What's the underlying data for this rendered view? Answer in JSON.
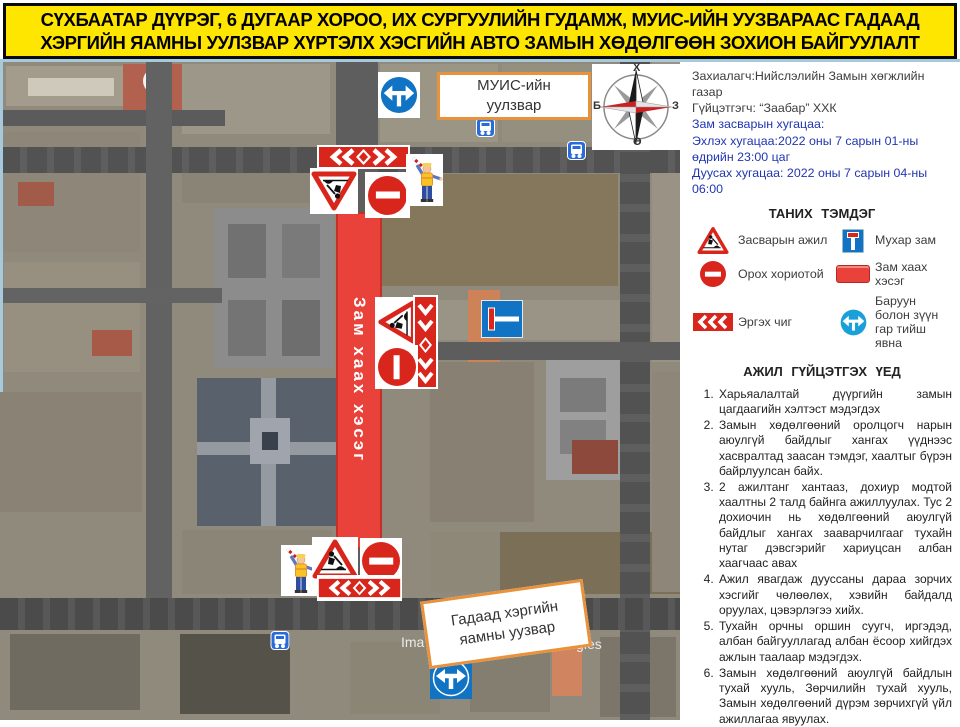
{
  "title": {
    "line1": "СҮХБААТАР ДҮҮРЭГ, 6 ДУГААР ХОРОО, ИХ СУРГУУЛИЙН ГУДАМЖ, МУИС-ИЙН УУЗВАРААС ГАДААД",
    "line2": "ХЭРГИЙН ЯАМНЫ УУЛЗВАР ХҮРТЭЛХ ХЭСГИЙН АВТО ЗАМЫН ХӨДӨЛГӨӨН ЗОХИОН БАЙГУУЛАЛТ"
  },
  "info": {
    "client": "Захиалагч:Нийслэлийн Замын хөгжлийн газар",
    "contractor": "Гүйцэтгэгч: “Заабар” ХХК",
    "duration_heading": "Зам засварын хугацаа:",
    "start": "Эхлэх хугацаа:2022 оны 7 сарын 01-ны өдрийн 23:00 цаг",
    "end": "Дуусах хугацаа: 2022 оны 7 сарын 04-ны 06:00"
  },
  "legend": {
    "heading": "ТАНИХ ТЭМДЭГ",
    "items": [
      {
        "icon": "roadwork-sign",
        "label": "Засварын ажил"
      },
      {
        "icon": "dead-end-sign",
        "label": "Мухар зам"
      },
      {
        "icon": "no-entry-sign",
        "label": "Орох хориотой"
      },
      {
        "icon": "road-closed-bar",
        "label": "Зам хаах хэсэг"
      },
      {
        "icon": "chevron-board",
        "label": "Эргэх чиг"
      },
      {
        "icon": "both-directions-sign",
        "label": "Баруун болон зүүн гар тийш явна"
      }
    ]
  },
  "procedures": {
    "heading": "АЖИЛ ГҮЙЦЭТГЭХ ҮЕД",
    "items": [
      "Харьяалалтай дүүргийн замын цагдаагийн хэлтэст мэдэгдэх",
      "Замын хөдөлгөөний оролцогч нарын аюулгүй байдлыг хангах үүднээс хасвралтад заасан тэмдэг, хаалтыг бүрэн байрлуулсан байх.",
      "2 ажилтанг хантааз, дохиур модтой хаалтны 2 талд байнга ажиллуулах. Тус 2 дохиочин нь хөдөлгөөний аюулгүй байдлыг хангах зааварчилгааг тухайн нутаг дэвсгэрийг хариуцсан албан хаагчаас авах",
      "Ажил явагдаж дууссаны дараа зорчих хэсгийг чөлөөлөх, хэвийн байдалд оруулах, цэвэрлэгээ хийх.",
      "Тухайн орчны оршин суугч, иргэдэд, албан байгууллагад албан ёсоор хийгдэх ажлын таалаар мэдэгдэх.",
      "Замын хөдөлгөөний аюулгүй байдлын тухай хууль, Зөрчилийн тухай хууль, Замын хөдөлгөөний дүрэм зөрчихгүй үйл ажиллагаа явуулах."
    ]
  },
  "map": {
    "label_top": {
      "line1": "МУИС-ийн",
      "line2": "уулзвар"
    },
    "label_bottom": {
      "line1": "Гадаад хэргийн",
      "line2": "яамны уузвар"
    },
    "closure_text": "Зам хаах хэсэг",
    "compass": {
      "north": "Х",
      "south": "Ө",
      "west": "Б",
      "east": "З"
    },
    "watermark_left": "Ima",
    "watermark_right": "Technologies"
  },
  "colors": {
    "title_bg": "#ffe600",
    "sign_red": "#d9261c",
    "sign_blue": "#1173c4",
    "closure_red": "#e8423a",
    "label_border": "#e8923c",
    "date_text_blue": "#2036b1"
  }
}
